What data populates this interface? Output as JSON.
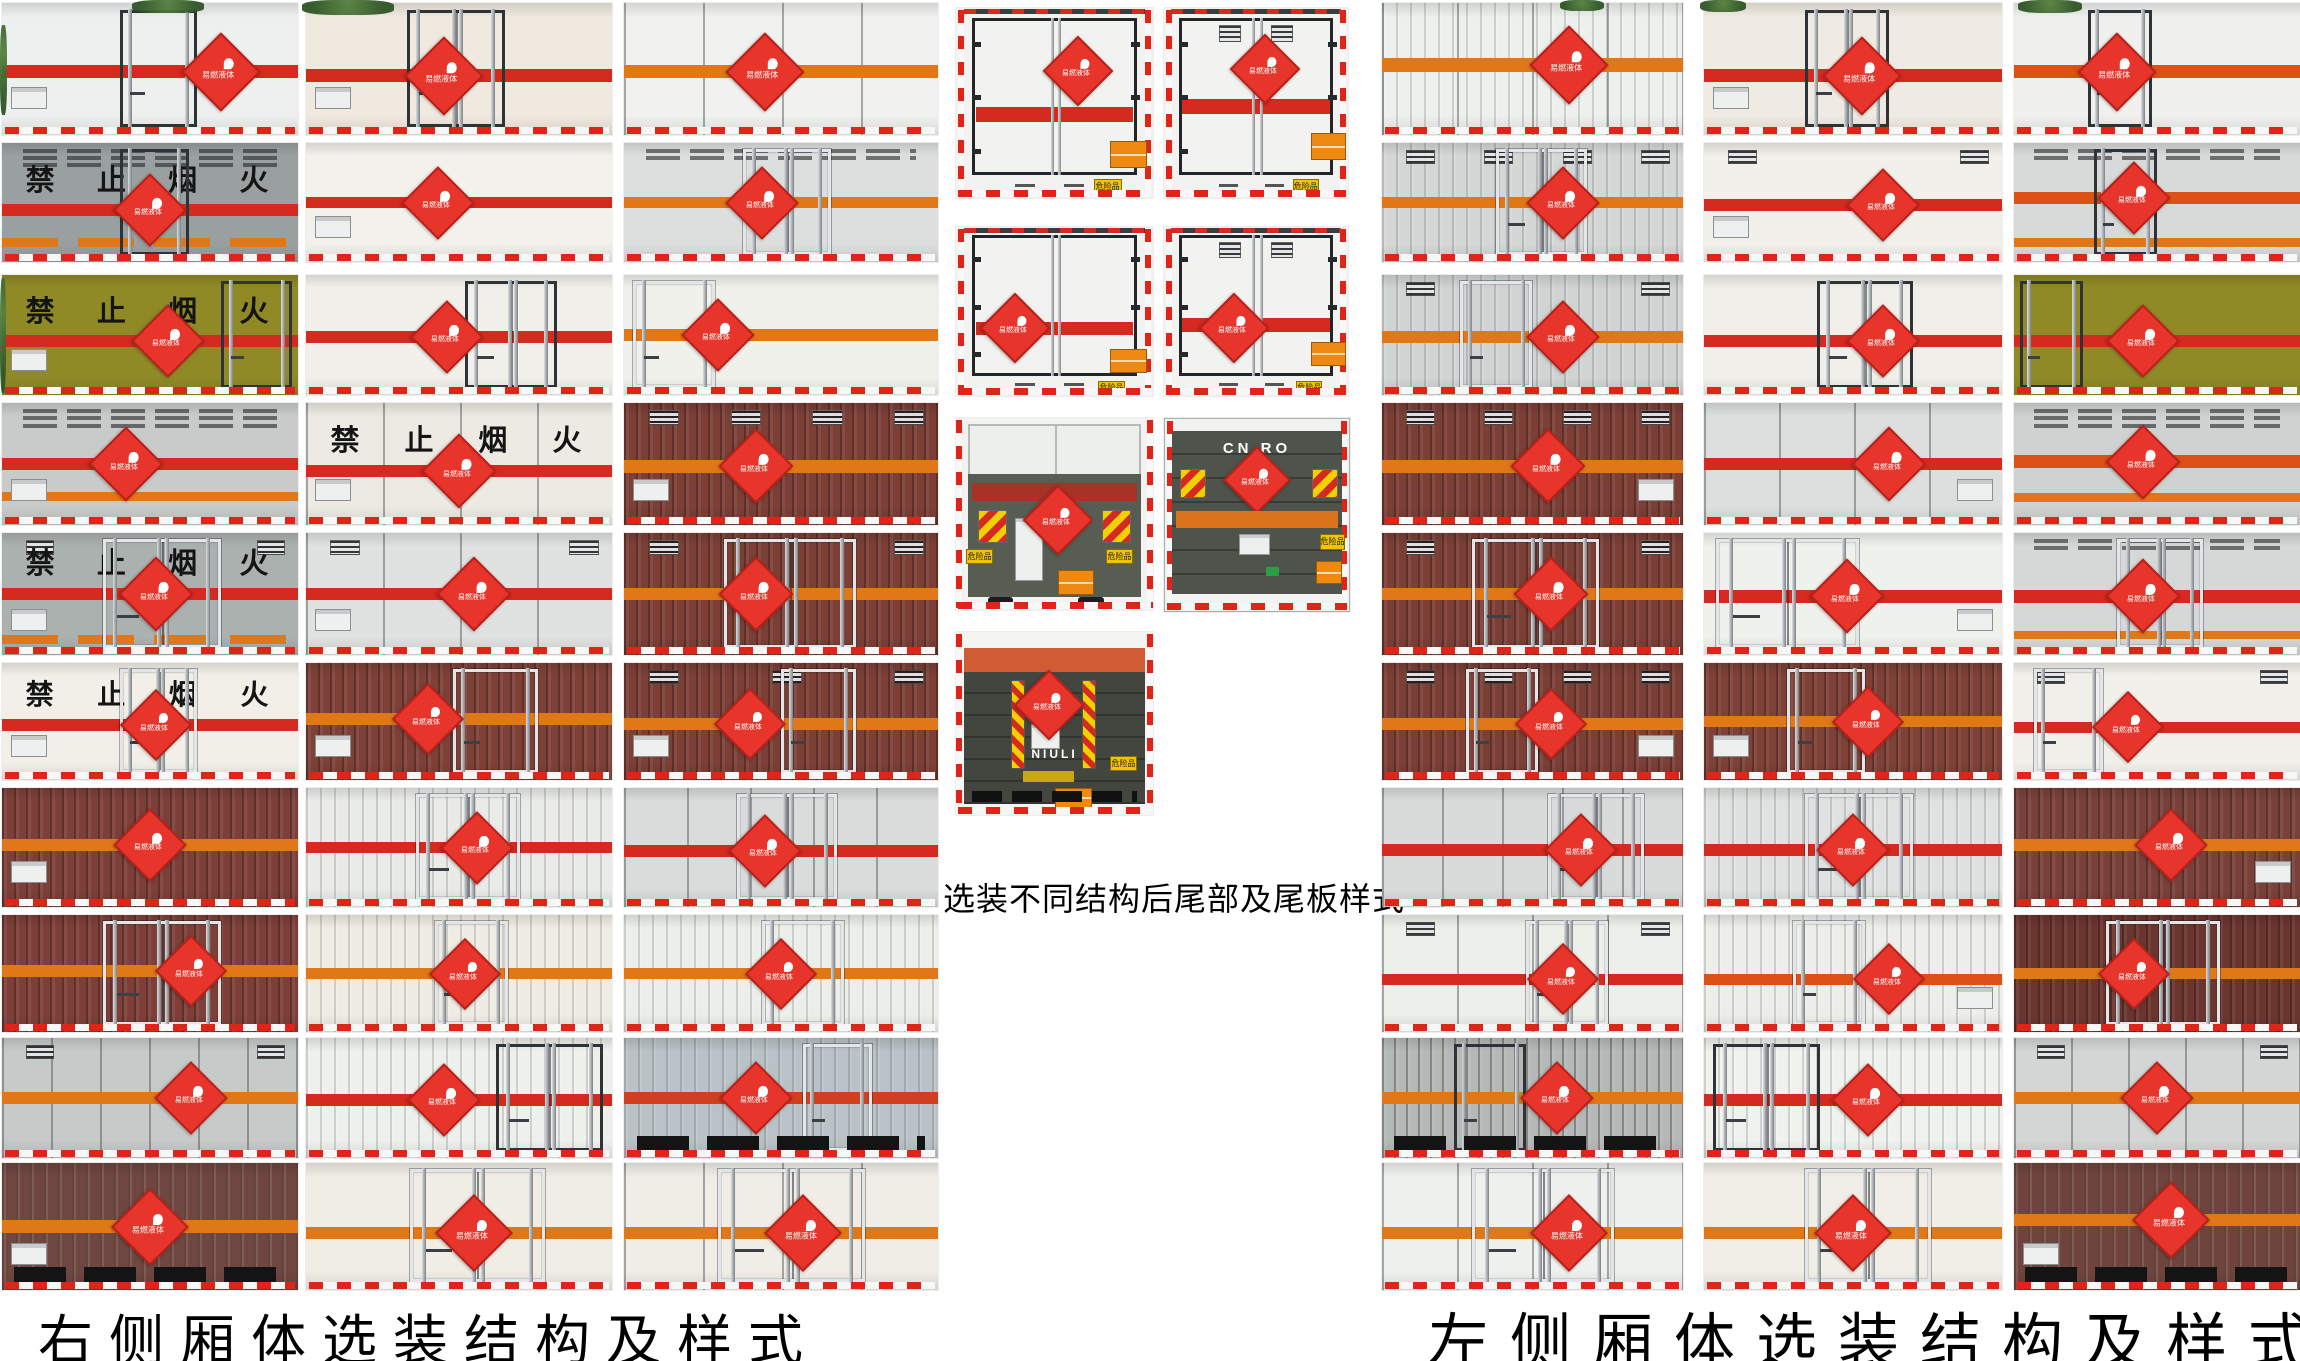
{
  "captions": {
    "right_side": "右侧厢体选装结构及样式",
    "rear_options": "选装不同结构后尾部及尾板样式",
    "left_side": "左侧厢体选装结构及样式"
  },
  "no_fire_text": "禁止烟火",
  "placard_label": "易燃液体",
  "hazard_plate_label": "危险品",
  "colors": {
    "stripe_red": "#d42a20",
    "stripe_orange": "#e07818",
    "stripe_orangered": "#dd5016",
    "placard_red": "#e8352b",
    "maroon_box": "#7b3f36",
    "reflective_red": "#e02418",
    "lift_platform": "#575d52"
  },
  "right_side_panels": [
    {
      "x": 2,
      "y": 3,
      "w": 296,
      "h": 132,
      "bg": "#edf0ef",
      "st": "#d42a20",
      "sy": 0.52,
      "d": {
        "x": 0.4,
        "w": 0.24,
        "t": "dark",
        "n": 1
      },
      "dx": 0.74,
      "pl": "l"
    },
    {
      "x": 2,
      "y": 143,
      "w": 296,
      "h": 119,
      "bg": "#9aa0a0",
      "tx": 1,
      "st": "#d42a20",
      "sy": 0.56,
      "s2": "seg",
      "s2y": 0.8,
      "d": {
        "x": 0.4,
        "w": 0.21,
        "t": "dark",
        "n": 1
      },
      "vl": 3,
      "dx": 0.5
    },
    {
      "x": 2,
      "y": 275,
      "w": 296,
      "h": 120,
      "bg": "#8f8a26",
      "tx": 1,
      "st": "#d42a20",
      "sy": 0.55,
      "d": {
        "x": 0.74,
        "w": 0.22,
        "t": "dark",
        "n": 1
      },
      "dx": 0.56,
      "pl": "l"
    },
    {
      "x": 2,
      "y": 403,
      "w": 296,
      "h": 122,
      "bg": "#c8cbca",
      "vl": 3,
      "st": "#d42a20",
      "sy": 0.5,
      "s2": "solid",
      "s2y": 0.73,
      "dx": 0.42,
      "pl": "l"
    },
    {
      "x": 2,
      "y": 533,
      "w": 296,
      "h": 122,
      "bg": "#abb1af",
      "tx": 1,
      "st": "#d42a20",
      "sy": 0.5,
      "s2": "seg",
      "s2y": 0.84,
      "d": {
        "x": 0.34,
        "w": 0.38,
        "t": "light",
        "n": 2
      },
      "v": 2,
      "dx": 0.52,
      "pl": "l"
    },
    {
      "x": 2,
      "y": 663,
      "w": 296,
      "h": 117,
      "bg": "#f1efe7",
      "tx": 1,
      "st": "#d42a20",
      "sy": 0.53,
      "d": {
        "x": 0.4,
        "w": 0.24,
        "t": "light",
        "n": 2
      },
      "dx": 0.52,
      "pl": "l"
    },
    {
      "x": 2,
      "y": 788,
      "w": 296,
      "h": 119,
      "bg": "#7c4038",
      "rib": 1,
      "st": "#e07818",
      "sy": 0.48,
      "dx": 0.5,
      "pl": "l"
    },
    {
      "x": 2,
      "y": 915,
      "w": 296,
      "h": 117,
      "bg": "#7c4038",
      "rib": 1,
      "st": "#e07818",
      "sy": 0.48,
      "d": {
        "x": 0.34,
        "w": 0.38,
        "t": "light",
        "n": 2
      },
      "dx": 0.64
    },
    {
      "x": 2,
      "y": 1038,
      "w": 296,
      "h": 120,
      "bg": "#c6cac9",
      "fr": 6,
      "st": "#e07818",
      "sy": 0.5,
      "v": 2,
      "dx": 0.64
    },
    {
      "x": 2,
      "y": 1163,
      "w": 296,
      "h": 127,
      "bg": "#6f4640",
      "rib": 2,
      "st": "#e07818",
      "sy": 0.5,
      "dx": 0.5,
      "slots": true,
      "pl": "l"
    },
    {
      "x": 306,
      "y": 3,
      "w": 306,
      "h": 132,
      "bg": "#efe9e0",
      "st": "#d42a20",
      "sy": 0.55,
      "d": {
        "x": 0.33,
        "w": 0.3,
        "t": "dark",
        "n": 2
      },
      "dx": 0.45,
      "pl": "l"
    },
    {
      "x": 306,
      "y": 143,
      "w": 306,
      "h": 119,
      "bg": "#f3f1eb",
      "st": "#d42a20",
      "sy": 0.5,
      "dx": 0.43,
      "pl": "l"
    },
    {
      "x": 306,
      "y": 275,
      "w": 306,
      "h": 120,
      "bg": "#f2f0ea",
      "st": "#d42a20",
      "sy": 0.52,
      "d": {
        "x": 0.52,
        "w": 0.28,
        "t": "dark",
        "n": 2
      },
      "dx": 0.46
    },
    {
      "x": 306,
      "y": 403,
      "w": 306,
      "h": 122,
      "bg": "#eceae2",
      "tx": 1,
      "st": "#d42a20",
      "sy": 0.56,
      "fr": 4,
      "dx": 0.5,
      "pl": "l"
    },
    {
      "x": 306,
      "y": 533,
      "w": 306,
      "h": 122,
      "bg": "#dfe2e0",
      "st": "#d42a20",
      "sy": 0.5,
      "fr": 4,
      "v": 2,
      "dx": 0.55,
      "pl": "l"
    },
    {
      "x": 306,
      "y": 663,
      "w": 306,
      "h": 117,
      "bg": "#7d4137",
      "rib": 1,
      "st": "#e07818",
      "sy": 0.48,
      "d": {
        "x": 0.48,
        "w": 0.26,
        "t": "light",
        "n": 1
      },
      "dx": 0.4,
      "pl": "l"
    },
    {
      "x": 306,
      "y": 788,
      "w": 306,
      "h": 119,
      "bg": "#e9ebe8",
      "rib": 2,
      "st": "#d42a20",
      "sy": 0.5,
      "d": {
        "x": 0.36,
        "w": 0.32,
        "t": "light",
        "n": 2
      },
      "dx": 0.56
    },
    {
      "x": 306,
      "y": 915,
      "w": 306,
      "h": 117,
      "bg": "#efece3",
      "rib": 2,
      "st": "#e07818",
      "sy": 0.5,
      "d": {
        "x": 0.42,
        "w": 0.22,
        "t": "light",
        "n": 1
      },
      "dx": 0.52
    },
    {
      "x": 306,
      "y": 1038,
      "w": 306,
      "h": 120,
      "bg": "#eef0ec",
      "rib": 2,
      "st": "#d42a20",
      "sy": 0.52,
      "d": {
        "x": 0.62,
        "w": 0.33,
        "t": "dark",
        "n": 2
      },
      "dx": 0.45
    },
    {
      "x": 306,
      "y": 1163,
      "w": 306,
      "h": 127,
      "bg": "#f0ede5",
      "st": "#e07818",
      "sy": 0.55,
      "d": {
        "x": 0.34,
        "w": 0.42,
        "t": "light",
        "n": 2
      },
      "dx": 0.55
    },
    {
      "x": 624,
      "y": 3,
      "w": 314,
      "h": 132,
      "bg": "#f1f2ef",
      "fr": 4,
      "st": "#e07818",
      "sy": 0.52,
      "dx": 0.45
    },
    {
      "x": 624,
      "y": 143,
      "w": 314,
      "h": 119,
      "bg": "#dcdfdd",
      "vl": 2,
      "st": "#e07818",
      "sy": 0.5,
      "d": {
        "x": 0.38,
        "w": 0.26,
        "t": "light",
        "n": 2
      },
      "dx": 0.44
    },
    {
      "x": 624,
      "y": 275,
      "w": 314,
      "h": 120,
      "bg": "#f1f1ec",
      "st": "#e07818",
      "sy": 0.5,
      "d": {
        "x": 0.03,
        "w": 0.24,
        "t": "light",
        "n": 1
      },
      "dx": 0.3
    },
    {
      "x": 624,
      "y": 403,
      "w": 314,
      "h": 122,
      "bg": "#7b3f36",
      "rib": 1,
      "v": 4,
      "st": "#e07818",
      "sy": 0.52,
      "dx": 0.42,
      "pl": "l"
    },
    {
      "x": 624,
      "y": 533,
      "w": 314,
      "h": 122,
      "bg": "#7b3f36",
      "rib": 1,
      "v": 2,
      "st": "#e07818",
      "sy": 0.5,
      "d": {
        "x": 0.32,
        "w": 0.4,
        "t": "light",
        "n": 2
      },
      "dx": 0.42
    },
    {
      "x": 624,
      "y": 663,
      "w": 314,
      "h": 117,
      "bg": "#7b3f36",
      "rib": 1,
      "v": 3,
      "st": "#e07818",
      "sy": 0.52,
      "d": {
        "x": 0.5,
        "w": 0.22,
        "t": "light",
        "n": 1
      },
      "dx": 0.4,
      "pl": "l"
    },
    {
      "x": 624,
      "y": 788,
      "w": 314,
      "h": 119,
      "bg": "#d9dcda",
      "fr": 5,
      "st": "#d42a20",
      "sy": 0.53,
      "d": {
        "x": 0.36,
        "w": 0.3,
        "t": "light",
        "n": 2
      },
      "dx": 0.45
    },
    {
      "x": 624,
      "y": 915,
      "w": 314,
      "h": 117,
      "bg": "#eceee9",
      "rib": 2,
      "st": "#e07818",
      "sy": 0.5,
      "d": {
        "x": 0.44,
        "w": 0.24,
        "t": "light",
        "n": 1
      },
      "dx": 0.5
    },
    {
      "x": 624,
      "y": 1038,
      "w": 314,
      "h": 120,
      "bg": "#b9c2c6",
      "rib": 2,
      "st": "#d0401f",
      "sy": 0.5,
      "d": {
        "x": 0.57,
        "w": 0.2,
        "t": "light",
        "n": 1
      },
      "dx": 0.42,
      "slots": true
    },
    {
      "x": 624,
      "y": 1163,
      "w": 314,
      "h": 127,
      "bg": "#f0ede6",
      "fr": 4,
      "st": "#e07818",
      "sy": 0.55,
      "d": {
        "x": 0.3,
        "w": 0.45,
        "t": "light",
        "n": 2
      },
      "dx": 0.57
    }
  ],
  "rear_views": [
    {
      "x": 956,
      "y": 8,
      "w": 197,
      "h": 190,
      "style": "doors",
      "dx": 0.62,
      "dy": 0.33,
      "sy": 0.56,
      "v": 0,
      "opx": 0.78,
      "opy": 0.7,
      "ypx": 0.7,
      "ypy": 0.9
    },
    {
      "x": 1164,
      "y": 8,
      "w": 184,
      "h": 190,
      "style": "doors",
      "dx": 0.55,
      "dy": 0.32,
      "sy": 0.52,
      "v": 2,
      "opx": 0.8,
      "opy": 0.66,
      "ypx": 0.7,
      "ypy": 0.9
    },
    {
      "x": 956,
      "y": 227,
      "w": 197,
      "h": 169,
      "style": "doors",
      "dx": 0.3,
      "dy": 0.6,
      "sy": 0.6,
      "v": 0,
      "opx": 0.78,
      "opy": 0.72,
      "ypx": 0.72,
      "ypy": 0.91
    },
    {
      "x": 1164,
      "y": 227,
      "w": 184,
      "h": 169,
      "style": "doors",
      "dx": 0.38,
      "dy": 0.6,
      "sy": 0.58,
      "v": 2,
      "opx": 0.8,
      "opy": 0.68,
      "ypx": 0.72,
      "ypy": 0.91
    },
    {
      "x": 956,
      "y": 418,
      "w": 197,
      "h": 192,
      "style": "lift_a"
    },
    {
      "x": 1164,
      "y": 418,
      "w": 184,
      "h": 192,
      "style": "lift_b",
      "logo": "CN RO"
    },
    {
      "x": 956,
      "y": 632,
      "w": 197,
      "h": 183,
      "style": "lift_c",
      "logo": "NIULI"
    }
  ],
  "left_side_panels": [
    {
      "x": 1382,
      "y": 3,
      "w": 301,
      "h": 132,
      "bg": "#eef0ed",
      "rib": 2,
      "fr": 4,
      "st": "#e07818",
      "sy": 0.47,
      "dx": 0.62
    },
    {
      "x": 1382,
      "y": 143,
      "w": 301,
      "h": 119,
      "bg": "#d4d7d5",
      "rib": 2,
      "v": 4,
      "st": "#e07818",
      "sy": 0.5,
      "d": {
        "x": 0.38,
        "w": 0.28,
        "t": "light",
        "n": 2
      },
      "dx": 0.6
    },
    {
      "x": 1382,
      "y": 275,
      "w": 301,
      "h": 120,
      "bg": "#d0d4d2",
      "rib": 2,
      "v": 2,
      "st": "#e07818",
      "sy": 0.52,
      "d": {
        "x": 0.26,
        "w": 0.22,
        "t": "light",
        "n": 1
      },
      "dx": 0.6
    },
    {
      "x": 1382,
      "y": 403,
      "w": 301,
      "h": 122,
      "bg": "#7b3f36",
      "rib": 1,
      "v": 4,
      "st": "#e07818",
      "sy": 0.52,
      "dx": 0.55,
      "pl": "r"
    },
    {
      "x": 1382,
      "y": 533,
      "w": 301,
      "h": 122,
      "bg": "#7b3f36",
      "rib": 1,
      "v": 2,
      "st": "#e07818",
      "sy": 0.5,
      "d": {
        "x": 0.3,
        "w": 0.4,
        "t": "light",
        "n": 2
      },
      "dx": 0.56
    },
    {
      "x": 1382,
      "y": 663,
      "w": 301,
      "h": 117,
      "bg": "#7b3f36",
      "rib": 1,
      "v": 4,
      "st": "#e07818",
      "sy": 0.52,
      "d": {
        "x": 0.28,
        "w": 0.22,
        "t": "light",
        "n": 1
      },
      "dx": 0.56,
      "pl": "r"
    },
    {
      "x": 1382,
      "y": 788,
      "w": 301,
      "h": 119,
      "bg": "#d8dbd9",
      "fr": 5,
      "st": "#d42a20",
      "sy": 0.52,
      "d": {
        "x": 0.55,
        "w": 0.3,
        "t": "light",
        "n": 2
      },
      "dx": 0.66
    },
    {
      "x": 1382,
      "y": 915,
      "w": 301,
      "h": 117,
      "bg": "#edefeb",
      "v": 2,
      "fr": 4,
      "st": "#d42a20",
      "sy": 0.55,
      "d": {
        "x": 0.48,
        "w": 0.25,
        "t": "light",
        "n": 2
      },
      "dx": 0.6
    },
    {
      "x": 1382,
      "y": 1038,
      "w": 301,
      "h": 120,
      "bg": "#b4b9b7",
      "rib": 1,
      "st": "#e07818",
      "sy": 0.5,
      "d": {
        "x": 0.24,
        "w": 0.22,
        "t": "dark",
        "n": 1
      },
      "dx": 0.58,
      "slots": true
    },
    {
      "x": 1382,
      "y": 1163,
      "w": 301,
      "h": 127,
      "bg": "#eff1ee",
      "fr": 4,
      "st": "#e07818",
      "sy": 0.55,
      "d": {
        "x": 0.3,
        "w": 0.45,
        "t": "light",
        "n": 2
      },
      "dx": 0.62
    },
    {
      "x": 1704,
      "y": 3,
      "w": 298,
      "h": 132,
      "bg": "#f0ebe2",
      "st": "#d42a20",
      "sy": 0.55,
      "d": {
        "x": 0.34,
        "w": 0.26,
        "t": "dark",
        "n": 2
      },
      "dx": 0.53,
      "pl": "l"
    },
    {
      "x": 1704,
      "y": 143,
      "w": 298,
      "h": 119,
      "bg": "#f2f0ea",
      "v": 2,
      "st": "#d42a20",
      "sy": 0.52,
      "dx": 0.6,
      "pl": "l"
    },
    {
      "x": 1704,
      "y": 275,
      "w": 298,
      "h": 120,
      "bg": "#f1efe9",
      "st": "#d42a20",
      "sy": 0.55,
      "d": {
        "x": 0.38,
        "w": 0.3,
        "t": "dark",
        "n": 2
      },
      "dx": 0.6
    },
    {
      "x": 1704,
      "y": 403,
      "w": 298,
      "h": 122,
      "bg": "#dcdfdd",
      "fr": 4,
      "st": "#d42a20",
      "sy": 0.5,
      "dx": 0.62,
      "pl": "r"
    },
    {
      "x": 1704,
      "y": 533,
      "w": 298,
      "h": 122,
      "bg": "#eff1ed",
      "st": "#d42a20",
      "sy": 0.52,
      "d": {
        "x": 0.04,
        "w": 0.46,
        "t": "light",
        "n": 2
      },
      "dx": 0.48,
      "pl": "r"
    },
    {
      "x": 1704,
      "y": 663,
      "w": 298,
      "h": 117,
      "bg": "#7d4137",
      "rib": 1,
      "st": "#e07818",
      "sy": 0.5,
      "d": {
        "x": 0.28,
        "w": 0.24,
        "t": "light",
        "n": 1
      },
      "dx": 0.55,
      "pl": "l"
    },
    {
      "x": 1704,
      "y": 788,
      "w": 298,
      "h": 119,
      "bg": "#dfe2e0",
      "rib": 2,
      "st": "#d42a20",
      "sy": 0.52,
      "d": {
        "x": 0.34,
        "w": 0.34,
        "t": "light",
        "n": 2
      },
      "dx": 0.5
    },
    {
      "x": 1704,
      "y": 915,
      "w": 298,
      "h": 117,
      "bg": "#edeeea",
      "rib": 2,
      "st": "#dd5016",
      "sy": 0.55,
      "d": {
        "x": 0.3,
        "w": 0.22,
        "t": "light",
        "n": 1
      },
      "dx": 0.62,
      "pl": "r"
    },
    {
      "x": 1704,
      "y": 1038,
      "w": 298,
      "h": 120,
      "bg": "#f0f2ee",
      "rib": 2,
      "st": "#d42a20",
      "sy": 0.52,
      "d": {
        "x": 0.03,
        "w": 0.34,
        "t": "dark",
        "n": 2
      },
      "dx": 0.55
    },
    {
      "x": 1704,
      "y": 1163,
      "w": 298,
      "h": 127,
      "bg": "#f1eee7",
      "st": "#e07818",
      "sy": 0.55,
      "d": {
        "x": 0.34,
        "w": 0.4,
        "t": "light",
        "n": 2
      },
      "dx": 0.5
    },
    {
      "x": 2014,
      "y": 3,
      "w": 286,
      "h": 132,
      "bg": "#f0f1ee",
      "st": "#dd5016",
      "sy": 0.52,
      "d": {
        "x": 0.26,
        "w": 0.2,
        "t": "dark",
        "n": 1
      },
      "dx": 0.36
    },
    {
      "x": 2014,
      "y": 143,
      "w": 286,
      "h": 119,
      "bg": "#d7dad8",
      "vl": 2,
      "st": "#dd5016",
      "sy": 0.46,
      "s2": "solid",
      "s2y": 0.8,
      "d": {
        "x": 0.28,
        "w": 0.2,
        "t": "dark",
        "n": 1
      },
      "dx": 0.42
    },
    {
      "x": 2014,
      "y": 275,
      "w": 286,
      "h": 120,
      "bg": "#8f8a26",
      "st": "#d42a20",
      "sy": 0.55,
      "d": {
        "x": 0.02,
        "w": 0.2,
        "t": "dark",
        "n": 1
      },
      "dx": 0.45
    },
    {
      "x": 2014,
      "y": 403,
      "w": 286,
      "h": 122,
      "bg": "#ced2d0",
      "vl": 3,
      "st": "#dd5016",
      "sy": 0.48,
      "s2": "solid",
      "s2y": 0.74,
      "dx": 0.45
    },
    {
      "x": 2014,
      "y": 533,
      "w": 286,
      "h": 122,
      "bg": "#d5d8d6",
      "vl": 2,
      "st": "#d42a20",
      "sy": 0.52,
      "s2": "solid",
      "s2y": 0.8,
      "d": {
        "x": 0.36,
        "w": 0.28,
        "t": "light",
        "n": 2
      },
      "dx": 0.45
    },
    {
      "x": 2014,
      "y": 663,
      "w": 286,
      "h": 117,
      "bg": "#f2f0eb",
      "v": 2,
      "st": "#d42a20",
      "sy": 0.55,
      "d": {
        "x": 0.07,
        "w": 0.22,
        "t": "light",
        "n": 1
      },
      "dx": 0.4
    },
    {
      "x": 2014,
      "y": 788,
      "w": 286,
      "h": 119,
      "bg": "#79413a",
      "rib": 1,
      "st": "#e07818",
      "sy": 0.48,
      "dx": 0.55,
      "pl": "r"
    },
    {
      "x": 2014,
      "y": 915,
      "w": 286,
      "h": 117,
      "bg": "#6b352f",
      "rib": 1,
      "st": "#e07818",
      "sy": 0.5,
      "d": {
        "x": 0.32,
        "w": 0.38,
        "t": "light",
        "n": 2
      },
      "dx": 0.42
    },
    {
      "x": 2014,
      "y": 1038,
      "w": 286,
      "h": 120,
      "bg": "#d3d6d4",
      "fr": 5,
      "v": 2,
      "st": "#e07818",
      "sy": 0.5,
      "dx": 0.5
    },
    {
      "x": 2014,
      "y": 1163,
      "w": 286,
      "h": 127,
      "bg": "#6f443d",
      "rib": 2,
      "st": "#e07818",
      "sy": 0.45,
      "dx": 0.55,
      "slots": true,
      "pl": "l"
    }
  ],
  "foliage": [
    {
      "x": 132,
      "y": 0,
      "w": 72,
      "h": 13
    },
    {
      "x": 302,
      "y": 0,
      "w": 92,
      "h": 15
    },
    {
      "x": 1560,
      "y": 0,
      "w": 44,
      "h": 11
    },
    {
      "x": 1700,
      "y": 0,
      "w": 46,
      "h": 12
    },
    {
      "x": 2018,
      "y": 0,
      "w": 64,
      "h": 13
    },
    {
      "x": 0,
      "y": 25,
      "w": 7,
      "h": 90
    },
    {
      "x": 0,
      "y": 278,
      "w": 6,
      "h": 115
    }
  ]
}
